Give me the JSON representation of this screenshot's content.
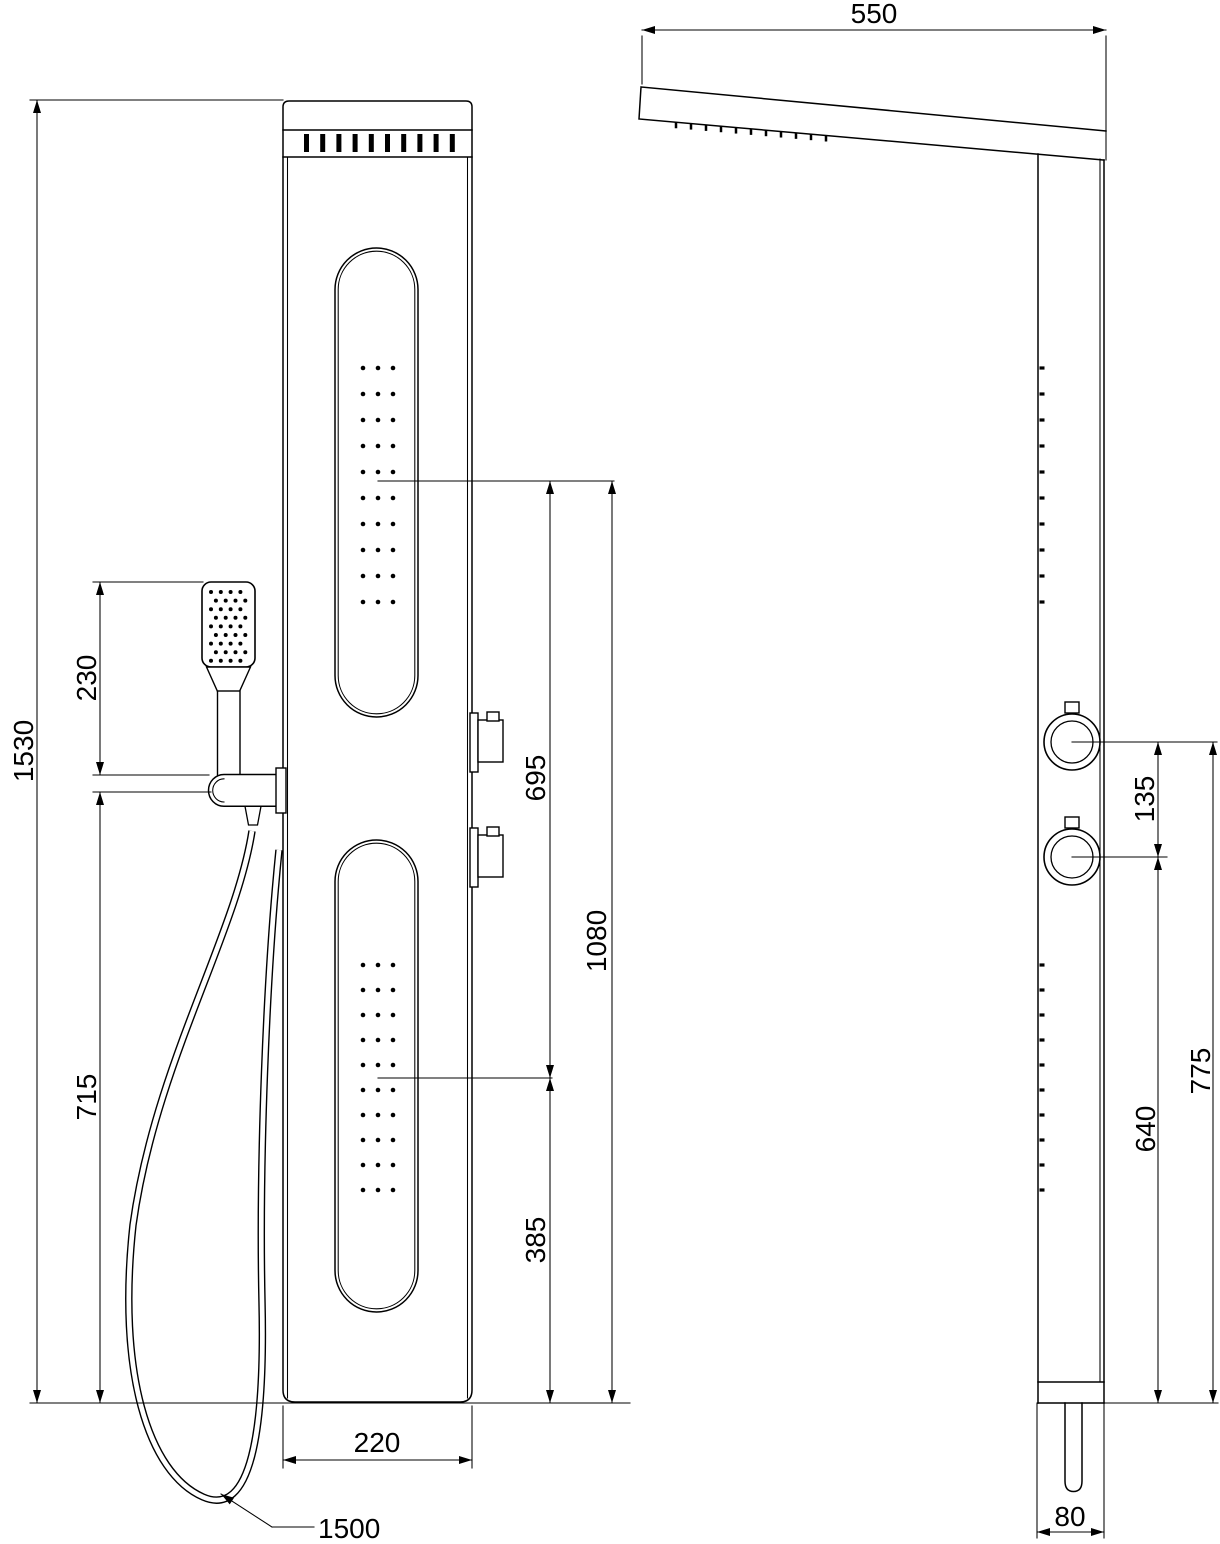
{
  "front": {
    "name": "Front view",
    "dims": {
      "overall_height": "1530",
      "handset_top_offset": "230",
      "holder_height": "715",
      "jet_center_spacing": "695",
      "upper_jet_center_height": "1080",
      "lower_jet_center_height": "385",
      "panel_width": "220",
      "hose_length": "1500"
    }
  },
  "side": {
    "name": "Side view",
    "dims": {
      "head_shower_projection": "550",
      "knob_center_spacing": "135",
      "lower_knob_height": "640",
      "upper_knob_height": "775",
      "panel_depth": "80"
    }
  },
  "colors": {
    "background": "#ffffff",
    "line": "#000000",
    "text": "#000000"
  }
}
